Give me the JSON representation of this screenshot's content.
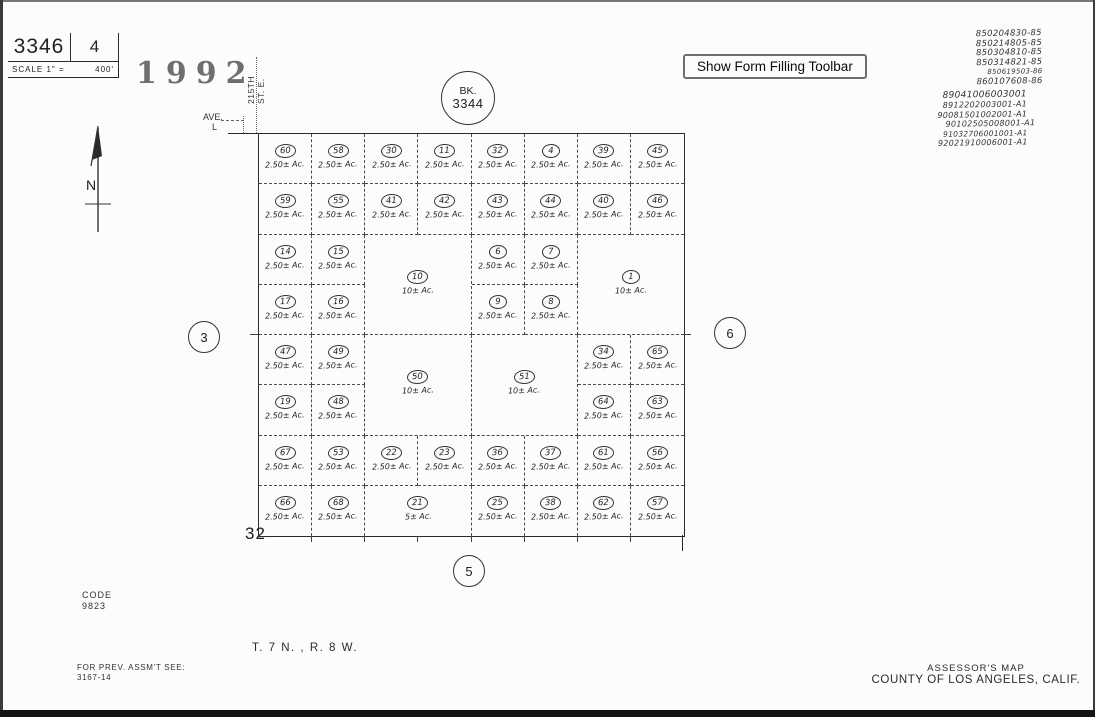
{
  "page": {
    "sheet_number": "3346",
    "page_number": "4",
    "scale_label": "SCALE 1\" =",
    "scale_value": "400'",
    "year_stamp": "1992",
    "street_vertical": {
      "line1": "215TH",
      "line2": "ST. E."
    },
    "avenue_label": "AVE.",
    "avenue_letter": "L",
    "north_label": "N",
    "book_circle": {
      "line1": "BK.",
      "line2": "3344"
    },
    "section_number": "32",
    "adjacent_pages": {
      "left": "3",
      "right": "6",
      "bottom": "5"
    },
    "code_label": "CODE",
    "code_value": "9823",
    "township_range": "T. 7 N. , R. 8 W.",
    "prev_assmt_label": "FOR PREV. ASSM'T SEE:",
    "prev_assmt_value": "3167-14",
    "assessor_line1": "ASSESSOR'S MAP",
    "assessor_line2": "COUNTY OF LOS ANGELES, CALIF."
  },
  "toolbar": {
    "show_form_filling_label": "Show Form Filling Toolbar"
  },
  "annotations": {
    "recording_numbers": [
      "850204830-85",
      "850214805-85",
      "850304810-85",
      "850314821-85",
      "850619503-86",
      "860107608-86",
      "89041006003001",
      "8912202003001-A1",
      "90081501002001-A1",
      "90102505008001-A1",
      "91032706001001-A1",
      "92021910006001-A1"
    ]
  },
  "map": {
    "grid": {
      "cols": 8,
      "rows": 8
    },
    "parcels": [
      {
        "n": "60",
        "ac": "2.50± Ac.",
        "c": 1,
        "r": 1
      },
      {
        "n": "58",
        "ac": "2.50± Ac.",
        "c": 2,
        "r": 1
      },
      {
        "n": "30",
        "ac": "2.50± Ac.",
        "c": 3,
        "r": 1
      },
      {
        "n": "11",
        "ac": "2.50± Ac.",
        "c": 4,
        "r": 1
      },
      {
        "n": "32",
        "ac": "2.50± Ac.",
        "c": 5,
        "r": 1
      },
      {
        "n": "4",
        "ac": "2.50± Ac.",
        "c": 6,
        "r": 1
      },
      {
        "n": "39",
        "ac": "2.50± Ac.",
        "c": 7,
        "r": 1
      },
      {
        "n": "45",
        "ac": "2.50± Ac.",
        "c": 8,
        "r": 1
      },
      {
        "n": "59",
        "ac": "2.50± Ac.",
        "c": 1,
        "r": 2
      },
      {
        "n": "55",
        "ac": "2.50± Ac.",
        "c": 2,
        "r": 2
      },
      {
        "n": "41",
        "ac": "2.50± Ac.",
        "c": 3,
        "r": 2
      },
      {
        "n": "42",
        "ac": "2.50± Ac.",
        "c": 4,
        "r": 2
      },
      {
        "n": "43",
        "ac": "2.50± Ac.",
        "c": 5,
        "r": 2
      },
      {
        "n": "44",
        "ac": "2.50± Ac.",
        "c": 6,
        "r": 2
      },
      {
        "n": "40",
        "ac": "2.50± Ac.",
        "c": 7,
        "r": 2
      },
      {
        "n": "46",
        "ac": "2.50± Ac.",
        "c": 8,
        "r": 2
      },
      {
        "n": "14",
        "ac": "2.50± Ac.",
        "c": 1,
        "r": 3
      },
      {
        "n": "15",
        "ac": "2.50± Ac.",
        "c": 2,
        "r": 3
      },
      {
        "n": "10",
        "ac": "10± Ac.",
        "c": 3,
        "r": 3,
        "cs": 2,
        "rs": 2
      },
      {
        "n": "6",
        "ac": "2.50± Ac.",
        "c": 5,
        "r": 3
      },
      {
        "n": "7",
        "ac": "2.50± Ac.",
        "c": 6,
        "r": 3
      },
      {
        "n": "1",
        "ac": "10± Ac.",
        "c": 7,
        "r": 3,
        "cs": 2,
        "rs": 2
      },
      {
        "n": "17",
        "ac": "2.50± Ac.",
        "c": 1,
        "r": 4
      },
      {
        "n": "16",
        "ac": "2.50± Ac.",
        "c": 2,
        "r": 4
      },
      {
        "n": "9",
        "ac": "2.50± Ac.",
        "c": 5,
        "r": 4
      },
      {
        "n": "8",
        "ac": "2.50± Ac.",
        "c": 6,
        "r": 4
      },
      {
        "n": "47",
        "ac": "2.50± Ac.",
        "c": 1,
        "r": 5
      },
      {
        "n": "49",
        "ac": "2.50± Ac.",
        "c": 2,
        "r": 5
      },
      {
        "n": "50",
        "ac": "10± Ac.",
        "c": 3,
        "r": 5,
        "cs": 2,
        "rs": 2
      },
      {
        "n": "51",
        "ac": "10± Ac.",
        "c": 5,
        "r": 5,
        "cs": 2,
        "rs": 2
      },
      {
        "n": "34",
        "ac": "2.50± Ac.",
        "c": 7,
        "r": 5
      },
      {
        "n": "65",
        "ac": "2.50± Ac.",
        "c": 8,
        "r": 5
      },
      {
        "n": "19",
        "ac": "2.50± Ac.",
        "c": 1,
        "r": 6
      },
      {
        "n": "48",
        "ac": "2.50± Ac.",
        "c": 2,
        "r": 6
      },
      {
        "n": "64",
        "ac": "2.50± Ac.",
        "c": 7,
        "r": 6
      },
      {
        "n": "63",
        "ac": "2.50± Ac.",
        "c": 8,
        "r": 6
      },
      {
        "n": "67",
        "ac": "2.50± Ac.",
        "c": 1,
        "r": 7
      },
      {
        "n": "53",
        "ac": "2.50± Ac.",
        "c": 2,
        "r": 7
      },
      {
        "n": "22",
        "ac": "2.50± Ac.",
        "c": 3,
        "r": 7
      },
      {
        "n": "23",
        "ac": "2.50± Ac.",
        "c": 4,
        "r": 7
      },
      {
        "n": "36",
        "ac": "2.50± Ac.",
        "c": 5,
        "r": 7
      },
      {
        "n": "37",
        "ac": "2.50± Ac.",
        "c": 6,
        "r": 7
      },
      {
        "n": "61",
        "ac": "2.50± Ac.",
        "c": 7,
        "r": 7
      },
      {
        "n": "56",
        "ac": "2.50± Ac.",
        "c": 8,
        "r": 7
      },
      {
        "n": "66",
        "ac": "2.50± Ac.",
        "c": 1,
        "r": 8
      },
      {
        "n": "68",
        "ac": "2.50± Ac.",
        "c": 2,
        "r": 8
      },
      {
        "n": "21",
        "ac": "5± Ac.",
        "c": 3,
        "r": 8,
        "cs": 2
      },
      {
        "n": "25",
        "ac": "2.50± Ac.",
        "c": 5,
        "r": 8
      },
      {
        "n": "38",
        "ac": "2.50± Ac.",
        "c": 6,
        "r": 8
      },
      {
        "n": "62",
        "ac": "2.50± Ac.",
        "c": 7,
        "r": 8
      },
      {
        "n": "57",
        "ac": "2.50± Ac.",
        "c": 8,
        "r": 8
      }
    ]
  }
}
